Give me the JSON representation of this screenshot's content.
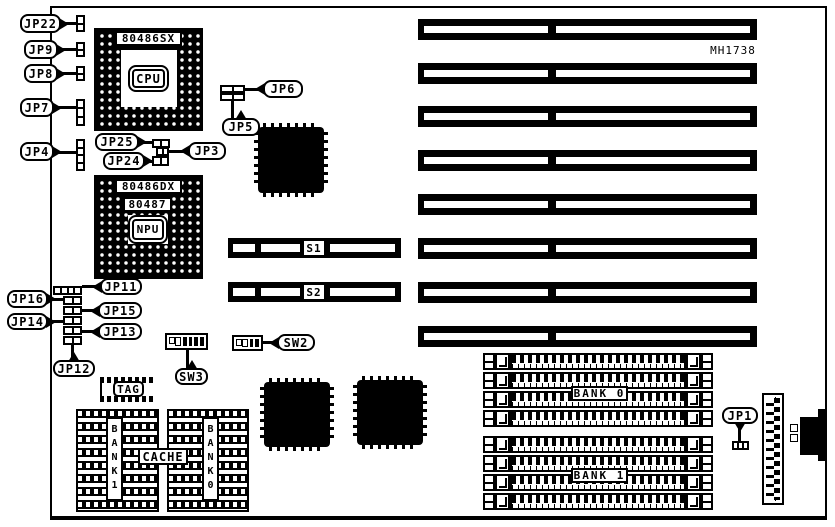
{
  "board": {
    "id_label": "MH1738",
    "ink": "#000000",
    "paper": "#ffffff"
  },
  "sockets": {
    "cpu": {
      "title": "80486SX",
      "center_label": "CPU"
    },
    "npu": {
      "title": "80486DX",
      "subtitle": "80487",
      "center_label": "NPU"
    }
  },
  "jumpers": {
    "jp22": "JP22",
    "jp9": "JP9",
    "jp8": "JP8",
    "jp7": "JP7",
    "jp4": "JP4",
    "jp25": "JP25",
    "jp24": "JP24",
    "jp3": "JP3",
    "jp6": "JP6",
    "jp5": "JP5",
    "jp11": "JP11",
    "jp16": "JP16",
    "jp15": "JP15",
    "jp14": "JP14",
    "jp13": "JP13",
    "jp12": "JP12",
    "jp1": "JP1"
  },
  "switches": {
    "s1": "S1",
    "s2": "S2",
    "sw2": "SW2",
    "sw3": "SW3"
  },
  "memory": {
    "bank0": "BANK 0",
    "bank1": "BANK 1"
  },
  "cache": {
    "label": "CACHE",
    "tag": "TAG",
    "bank1_col": "BANK1",
    "bank0_col": "BANK0"
  },
  "slots": {
    "isa_count": "8"
  }
}
